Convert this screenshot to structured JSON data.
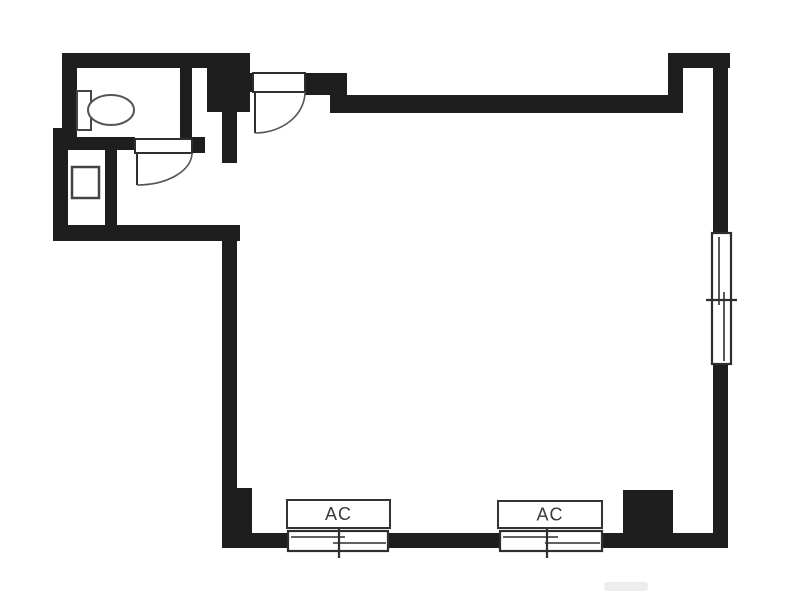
{
  "title": "floor-plan",
  "colors": {
    "wall": "#1e1e1e",
    "outline": "#2e2e2e",
    "fixture": "#444444",
    "arc": "#555555",
    "label": "#3a3a3a",
    "background": "#ffffff",
    "watermark": "#e9e9e9"
  },
  "floorplan": {
    "width": 787,
    "height": 598,
    "walls": [
      {
        "name": "wall-top-toilet",
        "x": 62,
        "y": 53,
        "w": 188,
        "h": 15
      },
      {
        "name": "wall-left-upper",
        "x": 62,
        "y": 53,
        "w": 15,
        "h": 85
      },
      {
        "name": "wall-left-jog",
        "x": 53,
        "y": 128,
        "w": 24,
        "h": 22
      },
      {
        "name": "wall-left-lower",
        "x": 53,
        "y": 138,
        "w": 15,
        "h": 102
      },
      {
        "name": "wall-hall-bottom",
        "x": 53,
        "y": 225,
        "w": 187,
        "h": 16
      },
      {
        "name": "wall-toilet-bottom",
        "x": 62,
        "y": 137,
        "w": 73,
        "h": 13
      },
      {
        "name": "wall-toilet-bottom-stub",
        "x": 192,
        "y": 137,
        "w": 13,
        "h": 16
      },
      {
        "name": "wall-toilet-right",
        "x": 180,
        "y": 65,
        "w": 12,
        "h": 75
      },
      {
        "name": "wall-entry-block",
        "x": 207,
        "y": 53,
        "w": 43,
        "h": 59
      },
      {
        "name": "wall-vestibule-left",
        "x": 222,
        "y": 112,
        "w": 15,
        "h": 51
      },
      {
        "name": "wall-closet-partition",
        "x": 105,
        "y": 148,
        "w": 12,
        "h": 77
      },
      {
        "name": "wall-entry-jamb-left",
        "x": 240,
        "y": 73,
        "w": 13,
        "h": 19
      },
      {
        "name": "wall-entry-jamb-right",
        "x": 305,
        "y": 73,
        "w": 42,
        "h": 22
      },
      {
        "name": "wall-top-main",
        "x": 330,
        "y": 95,
        "w": 352,
        "h": 18
      },
      {
        "name": "wall-topright-band",
        "x": 668,
        "y": 53,
        "w": 62,
        "h": 15
      },
      {
        "name": "wall-topright-return",
        "x": 668,
        "y": 68,
        "w": 15,
        "h": 45
      },
      {
        "name": "wall-right-upper",
        "x": 713,
        "y": 68,
        "w": 15,
        "h": 167
      },
      {
        "name": "wall-right-lower",
        "x": 713,
        "y": 363,
        "w": 15,
        "h": 185
      },
      {
        "name": "wall-left-main",
        "x": 222,
        "y": 240,
        "w": 15,
        "h": 293
      },
      {
        "name": "wall-pillar-bottomleft",
        "x": 222,
        "y": 488,
        "w": 30,
        "h": 45
      },
      {
        "name": "wall-bottom",
        "x": 222,
        "y": 533,
        "w": 506,
        "h": 15
      },
      {
        "name": "wall-column-bottomright",
        "x": 623,
        "y": 490,
        "w": 50,
        "h": 43
      }
    ],
    "doors": [
      {
        "name": "entrance-door",
        "frame": {
          "x": 253,
          "y": 73,
          "w": 52,
          "h": 19
        },
        "leaf": {
          "x1": 255,
          "y1": 92,
          "x2": 255,
          "y2": 133
        },
        "arc": "M 305 92 A 50 41 0 0 1 255 133"
      },
      {
        "name": "toilet-door",
        "frame": {
          "x": 135,
          "y": 139,
          "w": 57,
          "h": 14
        },
        "leaf": {
          "x1": 137,
          "y1": 153,
          "x2": 137,
          "y2": 185
        },
        "arc": "M 192 153 A 55 32 0 0 1 137 185"
      }
    ],
    "windows": [
      {
        "name": "window-right-sliding",
        "frame": {
          "x": 712,
          "y": 233,
          "w": 19,
          "h": 131
        },
        "panes": [
          {
            "x1": 719,
            "y1": 237,
            "x2": 719,
            "y2": 305
          },
          {
            "x1": 724,
            "y1": 292,
            "x2": 724,
            "y2": 361
          }
        ],
        "tick": {
          "x1": 706,
          "y1": 300,
          "x2": 737,
          "y2": 300
        }
      },
      {
        "name": "window-bottom-left",
        "frame": {
          "x": 288,
          "y": 531,
          "w": 100,
          "h": 20
        },
        "panes": [
          {
            "x1": 291,
            "y1": 537,
            "x2": 345,
            "y2": 537
          },
          {
            "x1": 333,
            "y1": 543,
            "x2": 386,
            "y2": 543
          }
        ],
        "tick": {
          "x1": 339,
          "y1": 512,
          "x2": 339,
          "y2": 558
        }
      },
      {
        "name": "window-bottom-right",
        "frame": {
          "x": 500,
          "y": 531,
          "w": 102,
          "h": 20
        },
        "panes": [
          {
            "x1": 503,
            "y1": 537,
            "x2": 558,
            "y2": 537
          },
          {
            "x1": 545,
            "y1": 543,
            "x2": 600,
            "y2": 543
          }
        ],
        "tick": {
          "x1": 547,
          "y1": 512,
          "x2": 547,
          "y2": 558
        }
      }
    ],
    "fixtures": {
      "toilet_tank": {
        "x": 77,
        "y": 91,
        "w": 14,
        "h": 39
      },
      "toilet_bowl": {
        "cx": 111,
        "cy": 110,
        "rx": 23,
        "ry": 15
      },
      "washer_pan": {
        "x": 72,
        "y": 167,
        "w": 27,
        "h": 31
      }
    },
    "ac_units": [
      {
        "label": "AC",
        "box": {
          "x": 287,
          "y": 500,
          "w": 103,
          "h": 28
        }
      },
      {
        "label": "AC",
        "box": {
          "x": 498,
          "y": 501,
          "w": 104,
          "h": 27
        }
      }
    ],
    "watermark": {
      "x": 604,
      "y": 582,
      "w": 44,
      "h": 9
    }
  }
}
